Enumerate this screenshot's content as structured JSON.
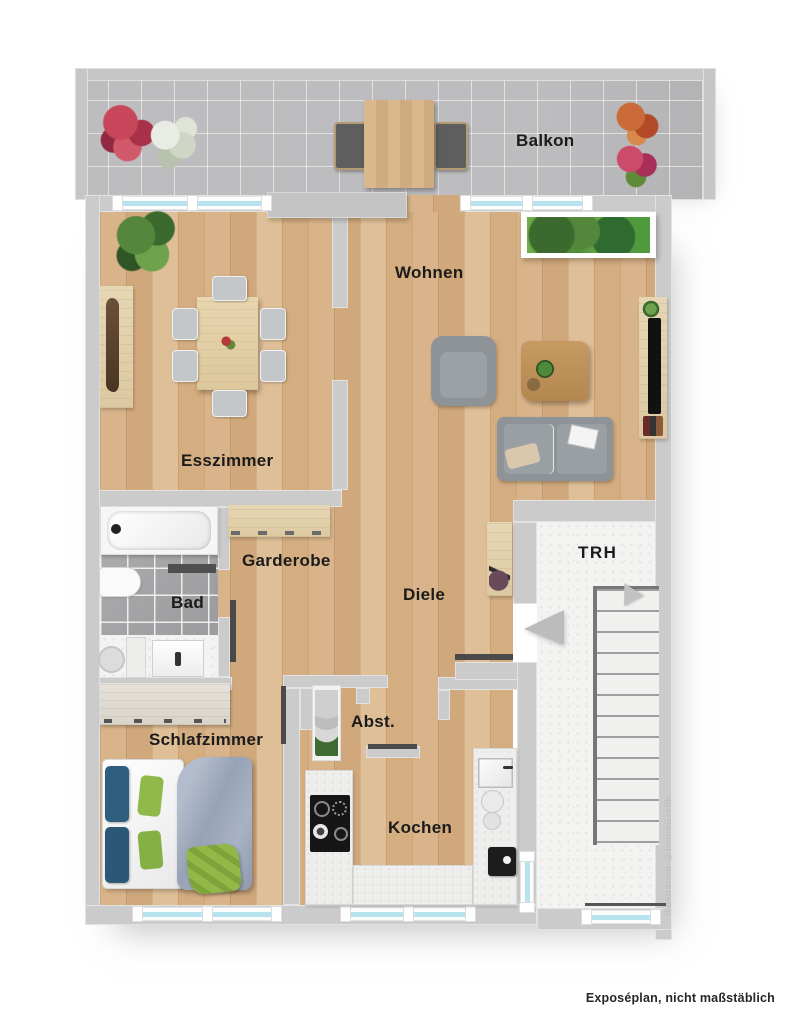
{
  "rooms": {
    "balkon": {
      "label": "Balkon"
    },
    "wohnen": {
      "label": "Wohnen"
    },
    "esszimmer": {
      "label": "Esszimmer"
    },
    "garderobe": {
      "label": "Garderobe"
    },
    "bad": {
      "label": "Bad"
    },
    "diele": {
      "label": "Diele"
    },
    "trh": {
      "label": "TRH"
    },
    "schlafzimmer": {
      "label": "Schlafzimmer"
    },
    "abst": {
      "label": "Abst."
    },
    "kochen": {
      "label": "Kochen"
    }
  },
  "footer": {
    "caption": "Exposéplan, nicht maßstäblich"
  },
  "watermark": {
    "text": "Illustration ©immoGrafik"
  },
  "colors": {
    "wall": "#cbcbcb",
    "wood": "#d7b289",
    "window_glass": "#b6e3ee",
    "balcony_concrete": "#b6b6b8",
    "bath_tile": "#9c9c9e",
    "sofa_gray": "#8e9397",
    "pillow_blue": "#2e5f7e",
    "pillow_green": "#8fba4a",
    "label_text": "#1b1b1b"
  }
}
